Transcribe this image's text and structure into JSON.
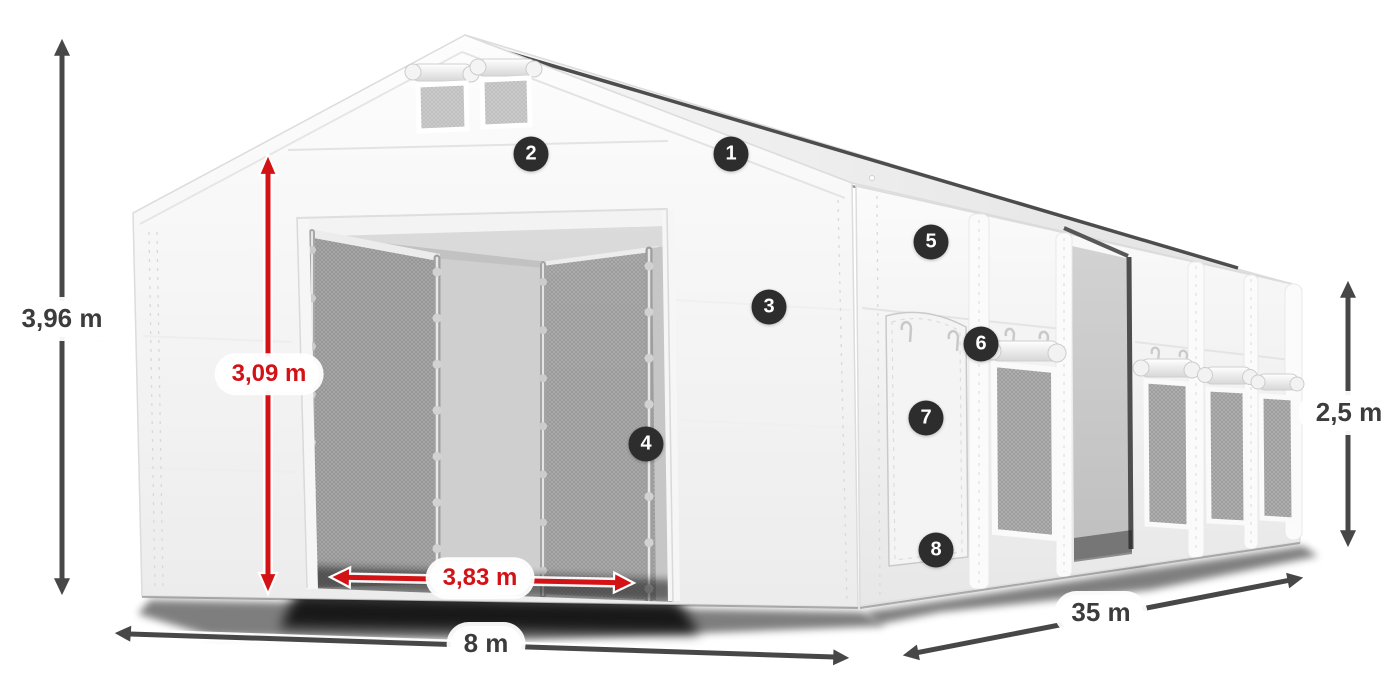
{
  "figure": {
    "description": "Storage tent product dimension diagram",
    "background": "#ffffff"
  },
  "colors": {
    "accent_red": "#d31216",
    "arrow_dark": "#474747",
    "callout_bg": "#2d2d2d",
    "callout_text": "#ffffff",
    "pill_bg": "#ffffff",
    "text_dark": "#3c3c3c"
  },
  "dimensions": {
    "total_height": {
      "label": "3,96 m",
      "style": "dark"
    },
    "entrance_height": {
      "label": "3,09 m",
      "style": "red"
    },
    "entrance_width": {
      "label": "3,83 m",
      "style": "red"
    },
    "width": {
      "label": "8 m",
      "style": "dark"
    },
    "length": {
      "label": "35 m",
      "style": "dark"
    },
    "side_height": {
      "label": "2,5 m",
      "style": "dark"
    }
  },
  "callouts": [
    {
      "number": "1"
    },
    {
      "number": "2"
    },
    {
      "number": "3"
    },
    {
      "number": "4"
    },
    {
      "number": "5"
    },
    {
      "number": "6"
    },
    {
      "number": "7"
    },
    {
      "number": "8"
    }
  ]
}
